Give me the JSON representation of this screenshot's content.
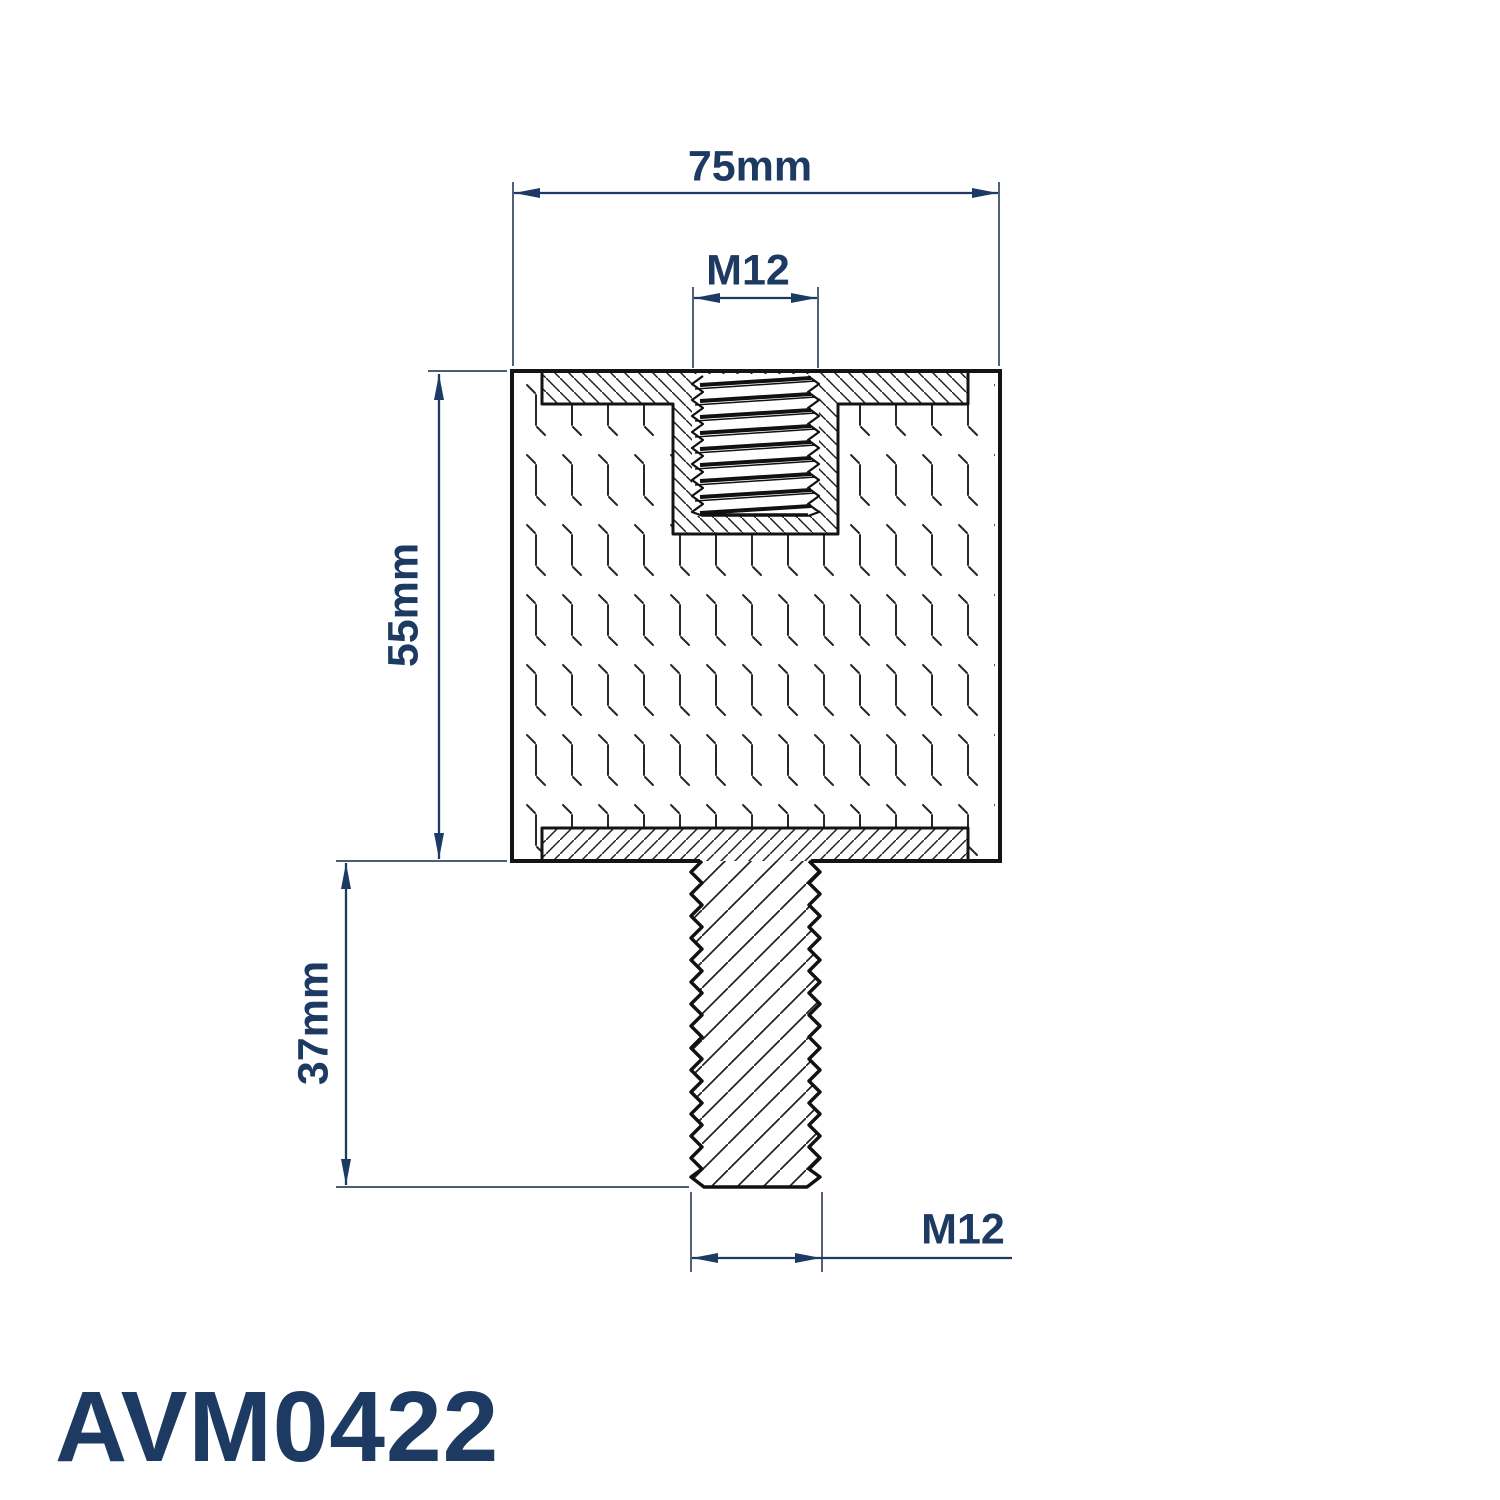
{
  "drawing": {
    "part_number": "AVM0422",
    "view": "section",
    "dimensions": {
      "body_width": "75mm",
      "body_height": "55mm",
      "stud_length": "37mm",
      "top_thread": "M12",
      "bottom_thread": "M12"
    },
    "colors": {
      "dimension": "#1d3a63",
      "outline": "#141414",
      "hatch": "#1f1f1f",
      "texture": "#262626"
    }
  }
}
